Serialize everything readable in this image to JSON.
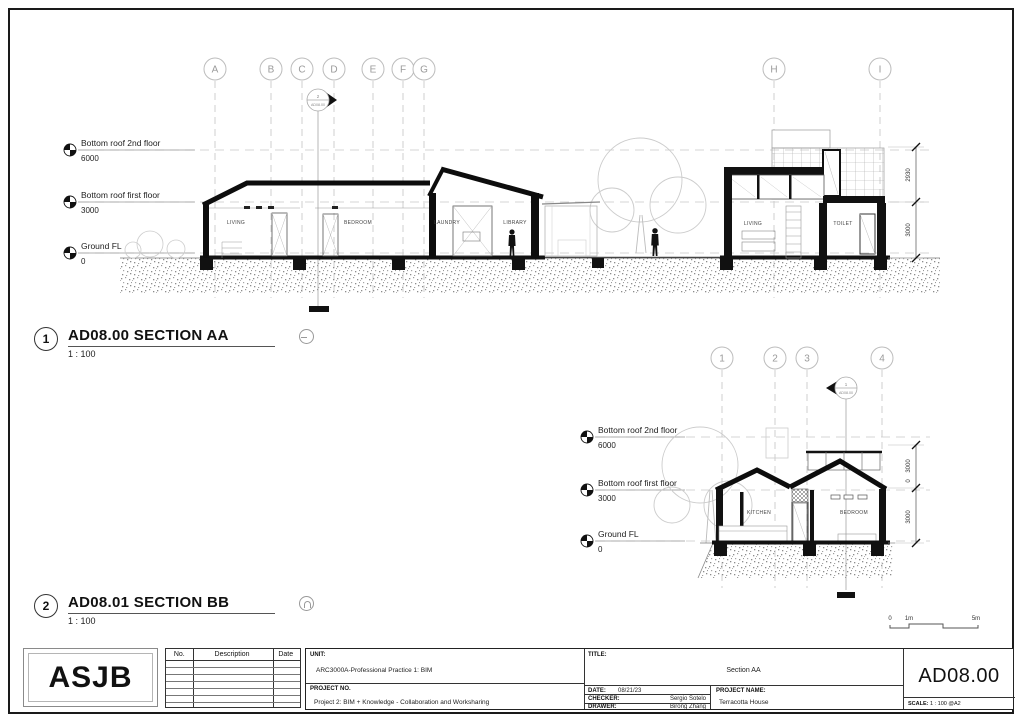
{
  "levels": [
    {
      "label": "Bottom roof 2nd floor",
      "value": "6000"
    },
    {
      "label": "Bottom roof first floor",
      "value": "3000"
    },
    {
      "label": "Ground FL",
      "value": "0"
    }
  ],
  "section_aa": {
    "grid": [
      "A",
      "B",
      "C",
      "D",
      "E",
      "F",
      "G",
      "H",
      "I"
    ],
    "marker": {
      "num": "2",
      "ref": "AD08.00"
    },
    "rooms": {
      "living1": "LIVING",
      "bedroom": "BEDROOM",
      "laundry": "LAUNDRY",
      "library": "LIBRARY",
      "living2": "LIVING",
      "toilet": "TOILET"
    },
    "dims": [
      "2930",
      "3000"
    ],
    "callout_num": "1",
    "title": "AD08.00 SECTION AA",
    "scale": "1 : 100"
  },
  "section_bb": {
    "grid": [
      "1",
      "2",
      "3",
      "4"
    ],
    "marker": {
      "num": "1",
      "ref": "AD08.00"
    },
    "rooms": {
      "kitchen": "KITCHEN",
      "bedroom": "BEDROOM"
    },
    "dims": [
      "3000",
      "0",
      "3000"
    ],
    "callout_num": "2",
    "title": "AD08.01 SECTION BB",
    "scale": "1 : 100"
  },
  "scale_bar": [
    "0",
    "1m",
    "5m"
  ],
  "titleblock": {
    "logo": "ASJB",
    "revisions": {
      "no": "No.",
      "description": "Description",
      "date": "Date"
    },
    "unit_label": "UNIT:",
    "unit_value": "ARC3000A-Professional Practice 1: BIM",
    "project_no_label": "PROJECT NO.",
    "project_no_value": "Project 2: BIM + Knowledge - Collaboration and Worksharing",
    "title_label": "TITLE:",
    "title_value": "Section AA",
    "date_label": "DATE:",
    "date_value": "08/21/23",
    "checker_label": "CHECKER:",
    "checker_value": "Sergio Sotelo",
    "drawer_label": "DRAWER:",
    "drawer_value": "Birong Zhang",
    "project_name_label": "PROJECT NAME:",
    "project_name_value": "Terracotta House",
    "sheet_number": "AD08.00",
    "scale_label": "SCALE:",
    "scale_value": "1 : 100 @A2"
  }
}
